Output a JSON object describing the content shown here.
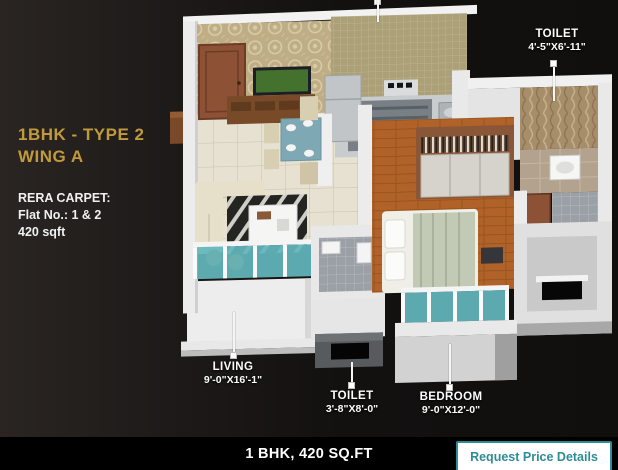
{
  "left_panel": {
    "title_line1": "1BHK - TYPE 2",
    "title_line2": "WING A",
    "title_color": "#c09a3c",
    "rera_heading": "RERA CARPET:",
    "rera_flat": "Flat No.: 1 & 2",
    "rera_area": "420 sqft"
  },
  "floor_plan": {
    "rooms": [
      {
        "name": "TOILET",
        "dimensions": "4'-5\"X6'-11\""
      },
      {
        "name": "LIVING",
        "dimensions": "9'-0\"X16'-1\""
      },
      {
        "name": "TOILET",
        "dimensions": "3'-8\"X8'-0\""
      },
      {
        "name": "BEDROOM",
        "dimensions": "9'-0\"X12'-0\""
      }
    ]
  },
  "footer": {
    "summary": "1 BHK, 420 SQ.FT",
    "cta_label": "Request Price Details",
    "cta_color": "#2d8d96"
  }
}
